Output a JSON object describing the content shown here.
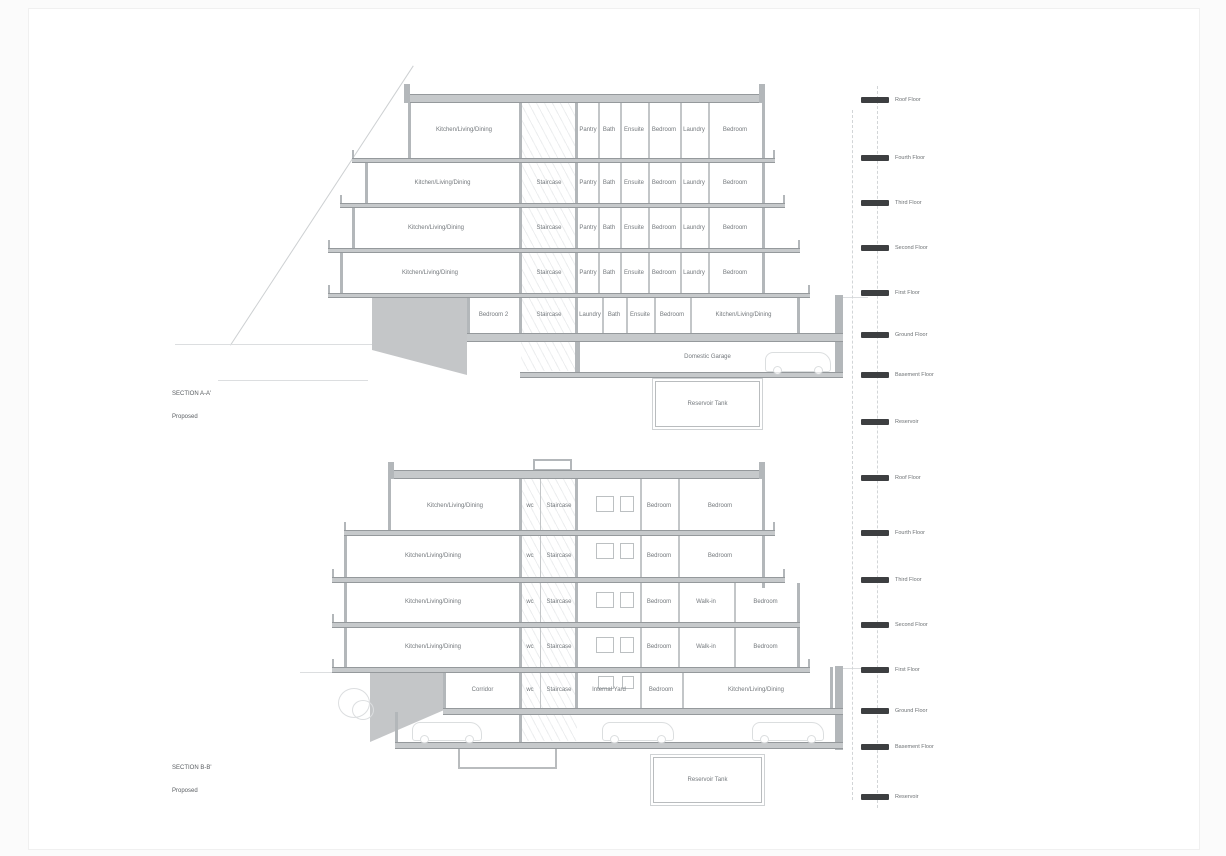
{
  "drawing": {
    "sectionA": {
      "title": "SECTION A-A'",
      "subtitle": "Proposed",
      "floors": [
        {
          "rooms": [
            "Kitchen/Living/Dining",
            "Pantry",
            "Bath",
            "Ensuite",
            "Bedroom",
            "Laundry",
            "Bedroom"
          ]
        },
        {
          "rooms": [
            "Kitchen/Living/Dining",
            "Staircase",
            "Pantry",
            "Bath",
            "Ensuite",
            "Bedroom",
            "Laundry",
            "Bedroom"
          ]
        },
        {
          "rooms": [
            "Kitchen/Living/Dining",
            "Staircase",
            "Pantry",
            "Bath",
            "Ensuite",
            "Bedroom",
            "Laundry",
            "Bedroom"
          ]
        },
        {
          "rooms": [
            "Kitchen/Living/Dining",
            "Staircase",
            "Pantry",
            "Bath",
            "Ensuite",
            "Bedroom",
            "Laundry",
            "Bedroom"
          ]
        },
        {
          "rooms": [
            "Bedroom 2",
            "Staircase",
            "Laundry",
            "Bath",
            "Ensuite",
            "Bedroom",
            "Kitchen/Living/Dining"
          ]
        }
      ],
      "garage_label": "Domestic Garage",
      "tank_label": "Reservoir Tank",
      "levels": [
        {
          "label": "Roof Floor"
        },
        {
          "label": "Fourth Floor"
        },
        {
          "label": "Third Floor"
        },
        {
          "label": "Second Floor"
        },
        {
          "label": "First Floor"
        },
        {
          "label": "Ground Floor"
        },
        {
          "label": "Basement Floor"
        },
        {
          "label": "Reservoir"
        }
      ]
    },
    "sectionB": {
      "title": "SECTION B-B'",
      "subtitle": "Proposed",
      "floors": [
        {
          "rooms": [
            "Kitchen/Living/Dining",
            "wc",
            "Staircase",
            "Bedroom",
            "Bedroom"
          ]
        },
        {
          "rooms": [
            "Kitchen/Living/Dining",
            "wc",
            "Staircase",
            "Bedroom",
            "Bedroom"
          ]
        },
        {
          "rooms": [
            "Kitchen/Living/Dining",
            "wc",
            "Staircase",
            "Bedroom",
            "Walk-in",
            "Bedroom"
          ]
        },
        {
          "rooms": [
            "Kitchen/Living/Dining",
            "wc",
            "Staircase",
            "Bedroom",
            "Walk-in",
            "Bedroom"
          ]
        },
        {
          "rooms": [
            "Corridor",
            "wc",
            "Staircase",
            "Internal Yard",
            "Bedroom",
            "Kitchen/Living/Dining"
          ]
        }
      ],
      "tank_label": "Reservoir Tank",
      "levels": [
        {
          "label": "Roof Floor"
        },
        {
          "label": "Fourth Floor"
        },
        {
          "label": "Third Floor"
        },
        {
          "label": "Second Floor"
        },
        {
          "label": "First Floor"
        },
        {
          "label": "Ground Floor"
        },
        {
          "label": "Basement Floor"
        },
        {
          "label": "Reservoir"
        }
      ]
    }
  }
}
